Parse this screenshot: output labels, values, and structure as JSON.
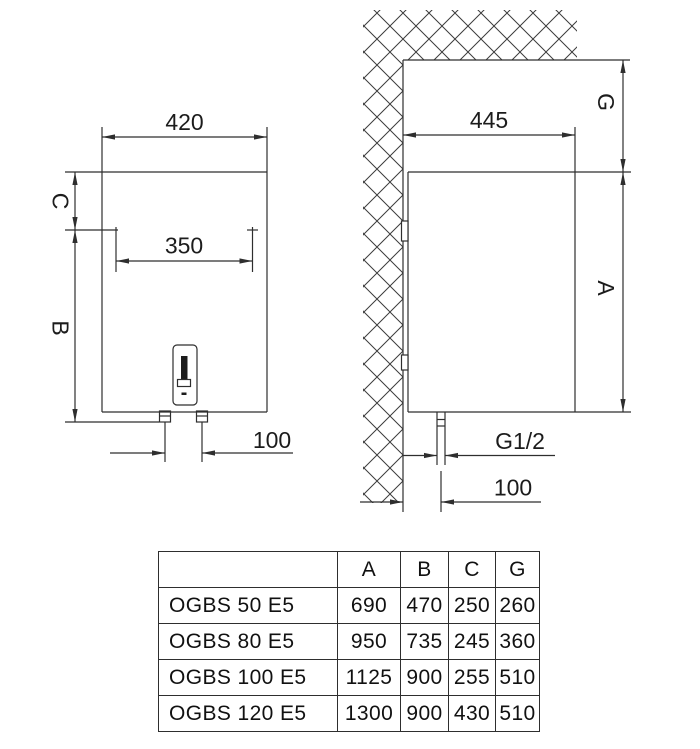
{
  "front_view": {
    "width": "420",
    "hole_spacing": "350",
    "top_offset": "C",
    "body_height": "B",
    "pipe_spacing": "100"
  },
  "side_view": {
    "depth": "445",
    "ceiling_gap": "G",
    "height": "A",
    "thread": "G1/2",
    "wall_offset": "100"
  },
  "table": {
    "headers": [
      "",
      "A",
      "B",
      "C",
      "G"
    ],
    "rows": [
      {
        "model": "OGBS 50 E5",
        "values": [
          "690",
          "470",
          "250",
          "260"
        ]
      },
      {
        "model": "OGBS 80 E5",
        "values": [
          "950",
          "735",
          "245",
          "360"
        ]
      },
      {
        "model": "OGBS 100 E5",
        "values": [
          "1125",
          "900",
          "255",
          "510"
        ]
      },
      {
        "model": "OGBS 120 E5",
        "values": [
          "1300",
          "900",
          "430",
          "510"
        ]
      }
    ]
  },
  "colors": {
    "line": "#2e2e2e",
    "text": "#1c1c1c",
    "background": "#ffffff"
  }
}
